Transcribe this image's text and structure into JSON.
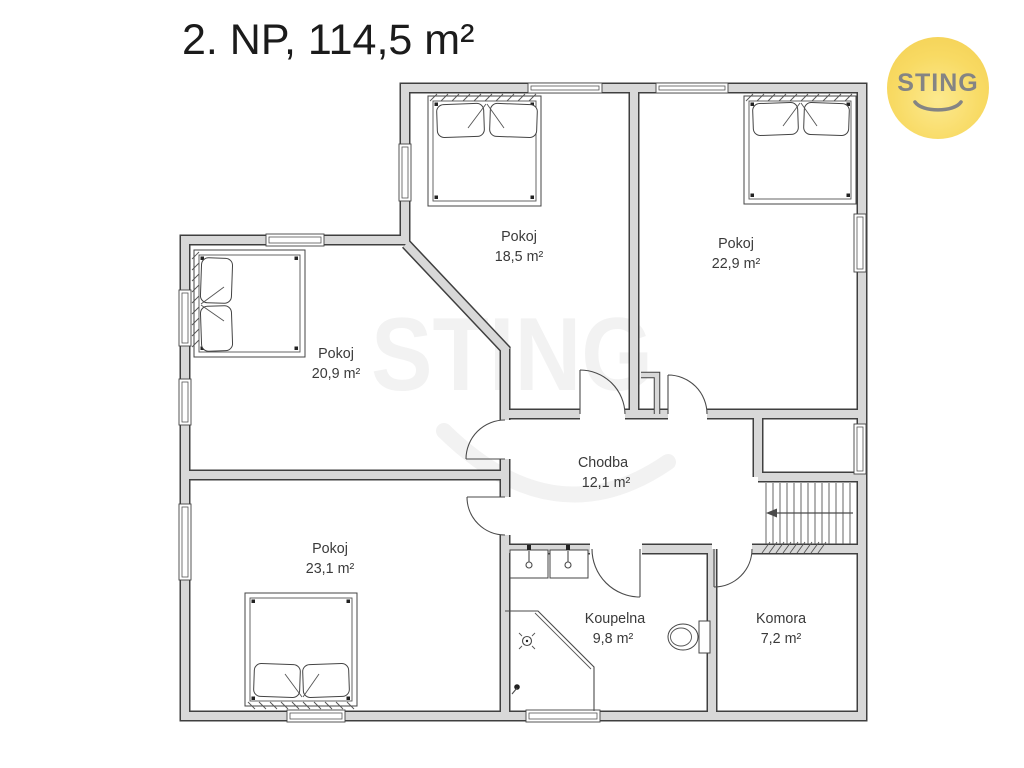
{
  "title": "2. NP, 114,5 m²",
  "logo": {
    "text": "STING"
  },
  "watermark": {
    "text": "STING"
  },
  "rooms": [
    {
      "name": "Pokoj",
      "area": "18,5 m²"
    },
    {
      "name": "Pokoj",
      "area": "22,9 m²"
    },
    {
      "name": "Pokoj",
      "area": "20,9 m²"
    },
    {
      "name": "Pokoj",
      "area": "23,1 m²"
    },
    {
      "name": "Chodba",
      "area": "12,1 m²"
    },
    {
      "name": "Koupelna",
      "area": "9,8 m²"
    },
    {
      "name": "Komora",
      "area": "7,2 m²"
    }
  ],
  "colors": {
    "wall_fill": "#d8d8d8",
    "wall_edge": "#3f3f3f",
    "line": "#4a4a4a",
    "label_text": "#3a3a3a",
    "logo_background": "#f6d45c",
    "logo_text": "#848484",
    "watermark": "#000000"
  }
}
